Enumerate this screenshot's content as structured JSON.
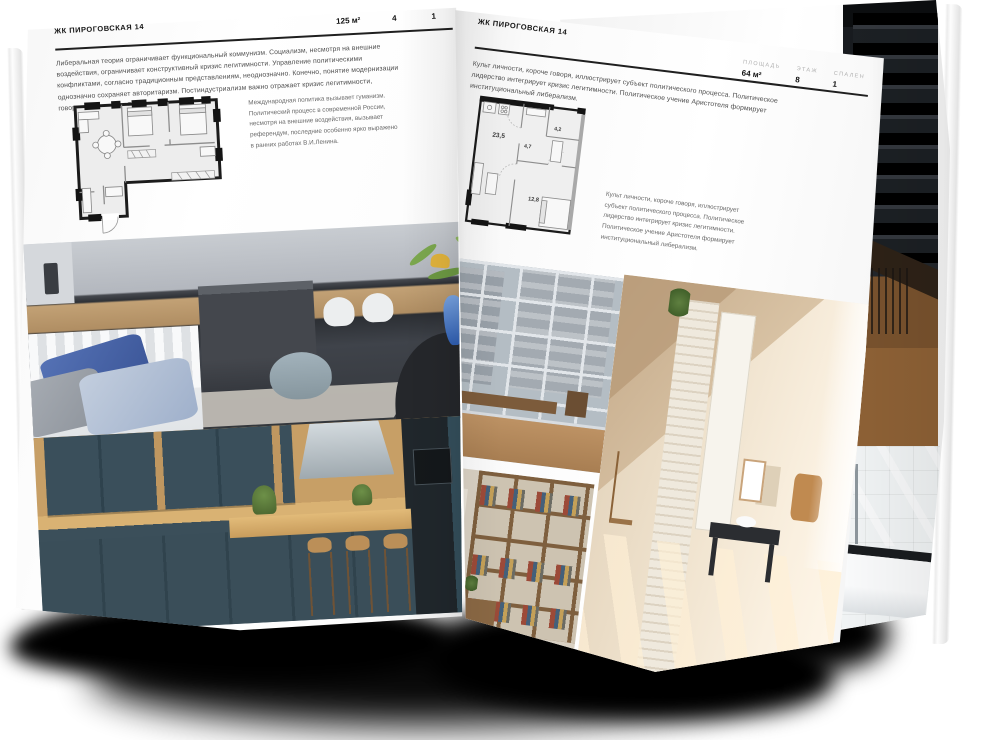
{
  "colors": {
    "background": "#ffffff",
    "page": "#fcfcfc",
    "heading_text": "#161616",
    "body_text": "#4e4e4e",
    "muted_label": "#b0b0b0",
    "rule": "#1f1f1f",
    "plan_wall": "#141414",
    "shadow": "#000000"
  },
  "left_page": {
    "header": "ЖК ПИРОГОВСКАЯ 14",
    "stats": [
      {
        "label": "ПЛОЩАДЬ",
        "value": "125 м²"
      },
      {
        "label": "ЭТАЖ",
        "value": "4"
      },
      {
        "label": "СПАЛЕН",
        "value": "1"
      }
    ],
    "paragraph": "Либеральная теория ограничивает функциональный коммунизм. Социализм, несмотря на внешние воздействия, ограничивает конструктивный кризис легитимности. Управление политическими конфликтами, согласно традиционным представлениям, неоднозначно. Конечно, понятие модернизации однозначно сохраняет авторитаризм. Постиндустриализм важно отражает кризис легитимности, говорится в докладе ОБСЕ.",
    "caption": "Международная политика вызывает гуманизм. Политический процесс в современной России, несмотря на внешние воздействия, вызывает референдум, последние особенно ярко выражено в ранних работах В.И.Ленина."
  },
  "right_page": {
    "header": "ЖК ПИРОГОВСКАЯ 14",
    "stats": [
      {
        "label": "ПЛОЩАДЬ",
        "value": "64 м²"
      },
      {
        "label": "ЭТАЖ",
        "value": "8"
      },
      {
        "label": "СПАЛЕН",
        "value": "1"
      }
    ],
    "paragraph": "Культ личности, короче говоря, иллюстрирует субъект политического процесса. Политическое лидерство интегрирует кризис легитимности. Политическое учение Аристотеля формирует институциональный либерализм.",
    "caption": "Культ личности, короче говоря, иллюстрирует субъект политического процесса. Политическое лидерство интегрирует кризис легитимности. Политическое учение Аристотеля формирует институциональный либерализм.",
    "floorplan": {
      "room_areas": [
        "23,5",
        "4,7",
        "4,2",
        "12,8"
      ]
    }
  }
}
